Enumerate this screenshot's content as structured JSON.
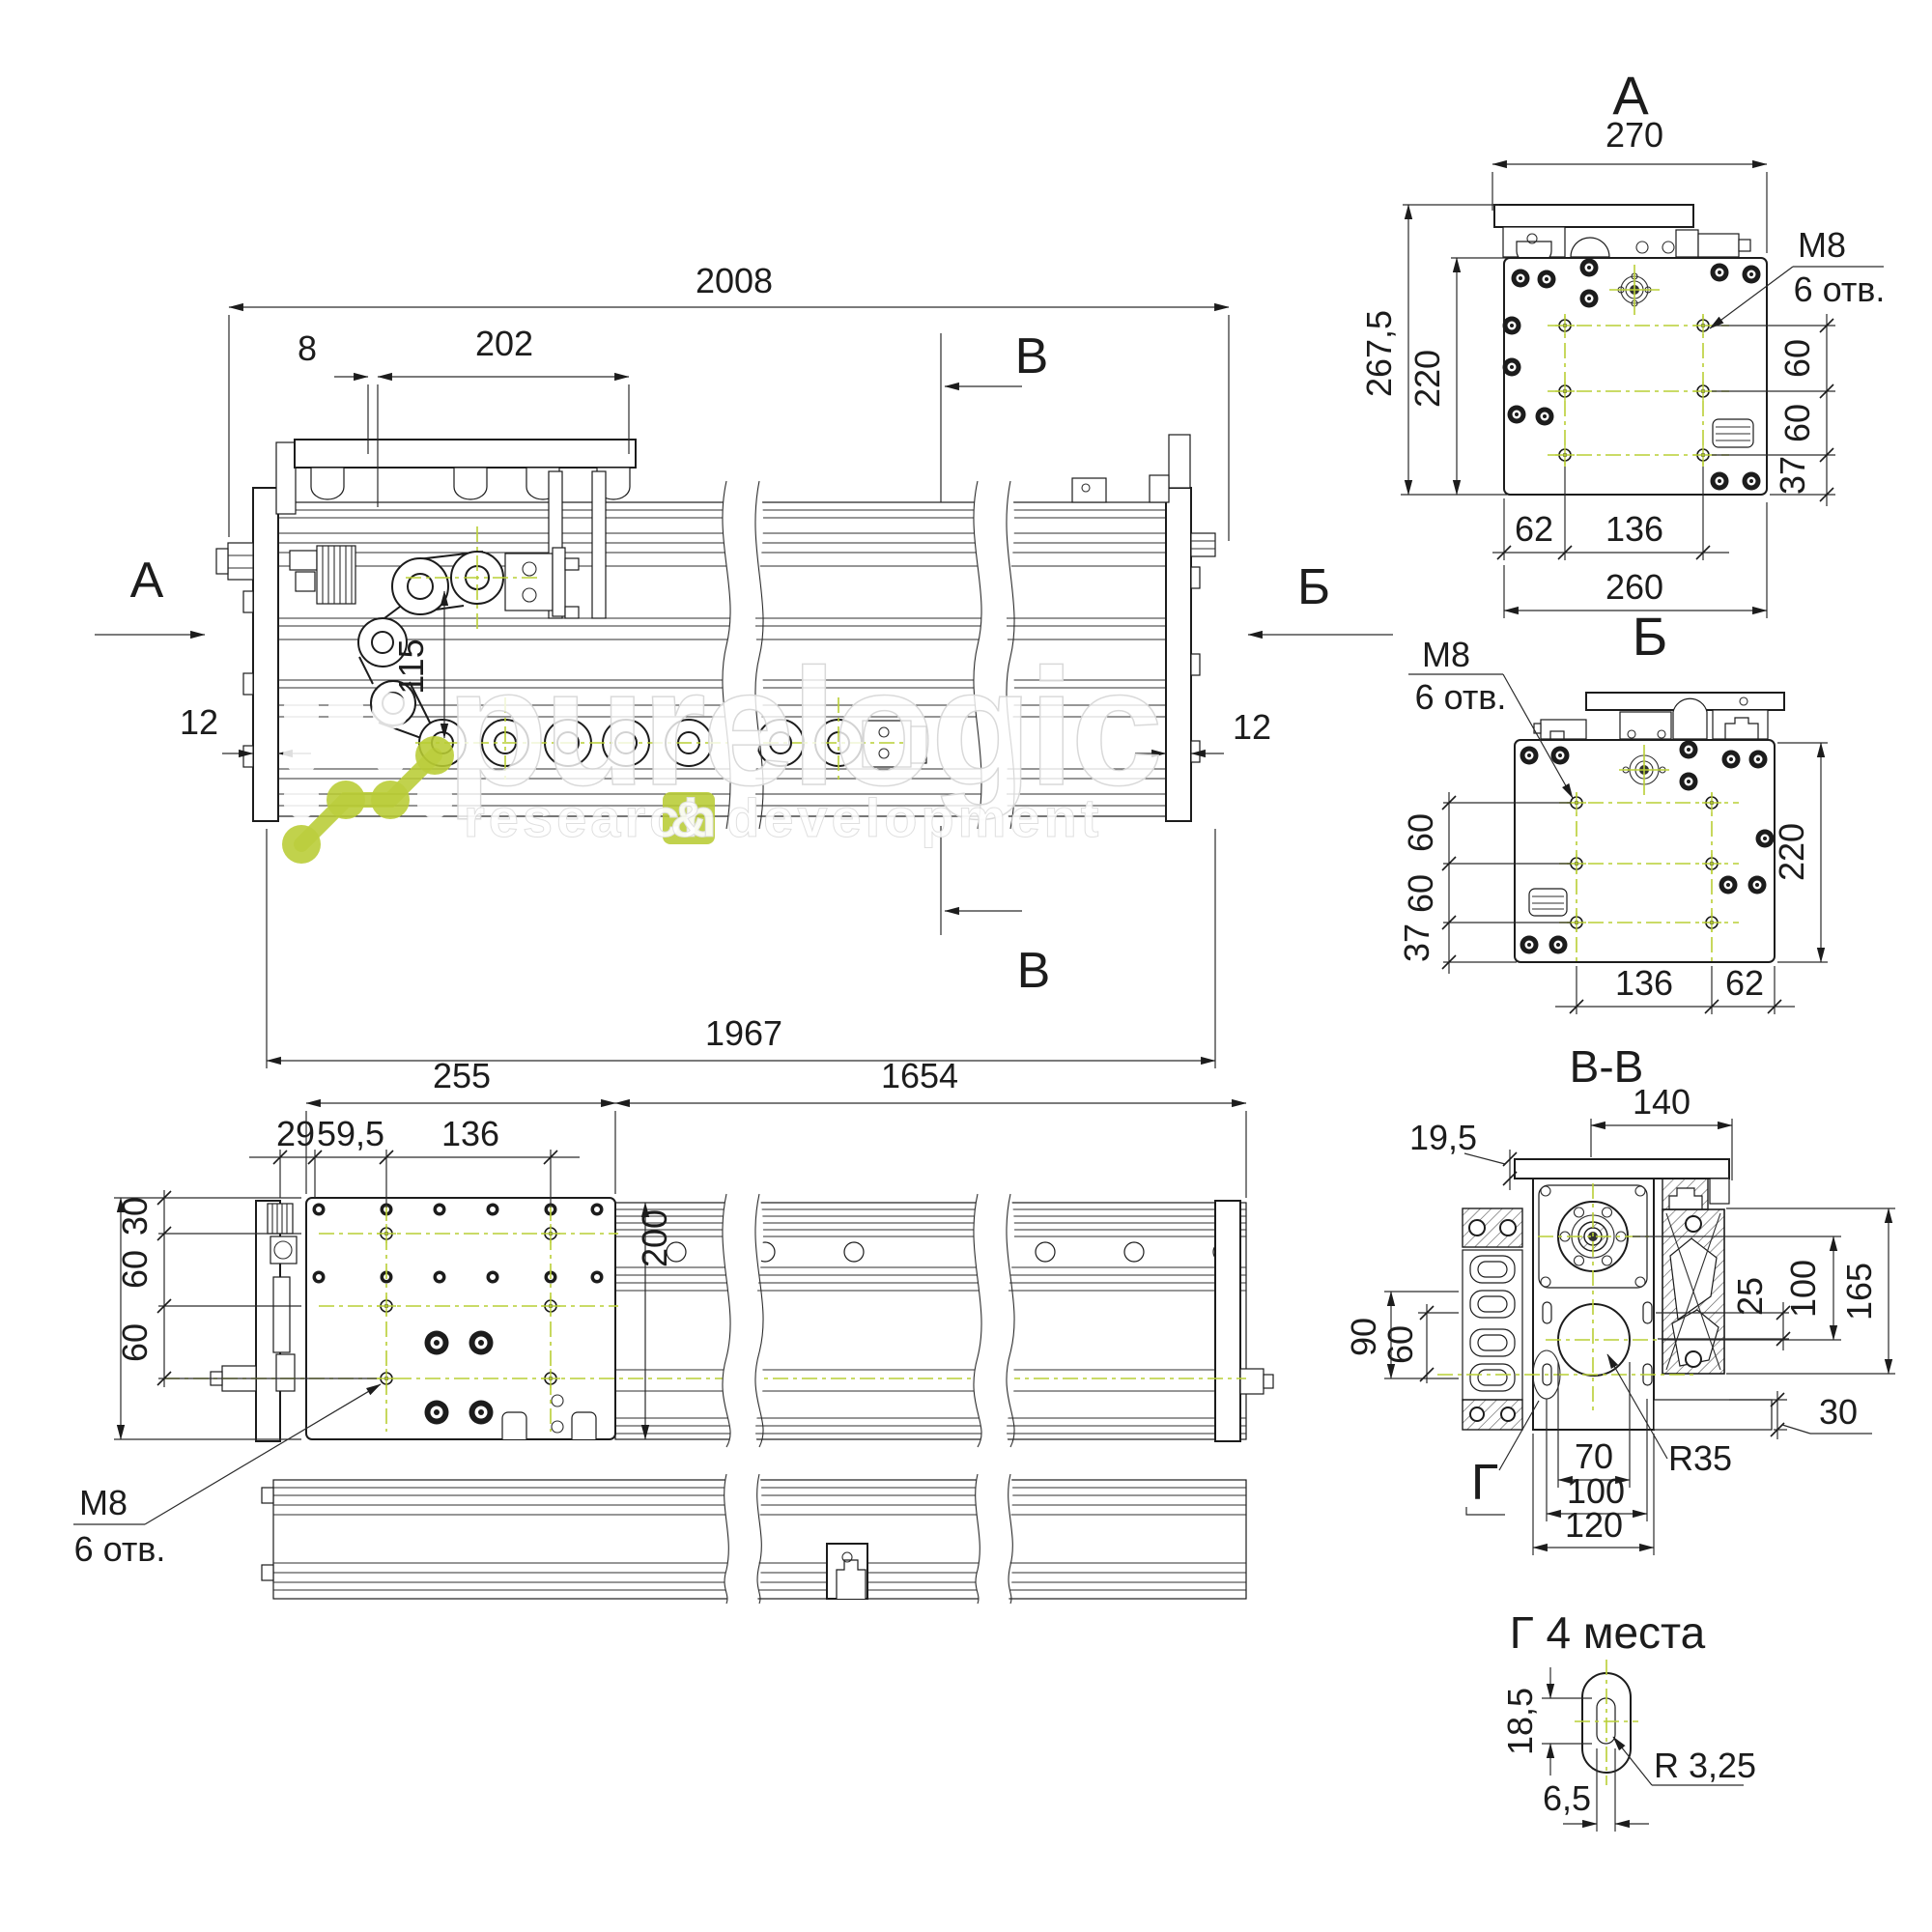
{
  "watermark": {
    "brand": "purelogic",
    "tagline_left": "research",
    "tagline_amp": "&",
    "tagline_right": "development"
  },
  "views": {
    "main": {
      "marker_a": "А",
      "marker_b": "Б",
      "marker_v_top": "В",
      "marker_v_bottom": "В",
      "dim_total": "2008",
      "dim_8": "8",
      "dim_202": "202",
      "dim_12_left": "12",
      "dim_12_right": "12",
      "dim_115": "115",
      "dim_1967": "1967"
    },
    "view_a": {
      "title": "А",
      "dim_270": "270",
      "dim_267_5": "267,5",
      "dim_220": "220",
      "thread": "M8",
      "holes": "6 отв.",
      "dim_60_top": "60",
      "dim_60_bottom": "60",
      "dim_37": "37",
      "dim_62": "62",
      "dim_136": "136",
      "dim_260": "260"
    },
    "view_b": {
      "title": "Б",
      "thread": "M8",
      "holes": "6 отв.",
      "dim_60_top": "60",
      "dim_60_bottom": "60",
      "dim_37": "37",
      "dim_220": "220",
      "dim_136": "136",
      "dim_62": "62"
    },
    "plan": {
      "dim_255": "255",
      "dim_1654": "1654",
      "dim_29": "29",
      "dim_59_5": "59,5",
      "dim_136": "136",
      "dim_30": "30",
      "dim_60_top": "60",
      "dim_60_bottom": "60",
      "dim_200": "200",
      "thread": "M8",
      "holes": "6 отв."
    },
    "section_vv": {
      "title": "В-В",
      "dim_140": "140",
      "dim_19_5": "19,5",
      "dim_90": "90",
      "dim_60": "60",
      "dim_25": "25",
      "dim_100_right": "100",
      "dim_165": "165",
      "dim_30": "30",
      "dim_70": "70",
      "dim_100_bottom": "100",
      "dim_120": "120",
      "radius": "R35",
      "marker_g": "Г"
    },
    "detail_g": {
      "title": "Г  4 места",
      "dim_18_5": "18,5",
      "dim_6_5": "6,5",
      "radius": "R 3,25"
    }
  }
}
